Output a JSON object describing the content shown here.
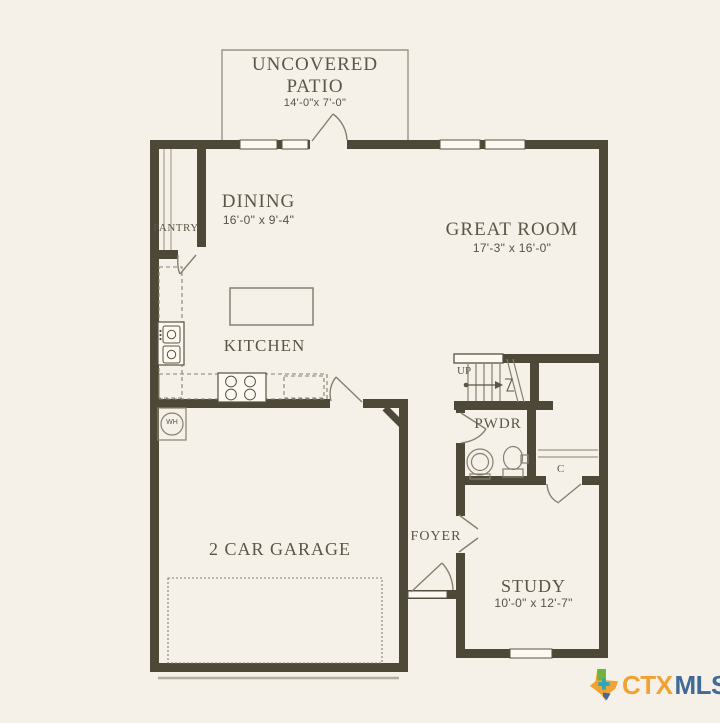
{
  "rooms": {
    "patio": {
      "name": "UNCOVERED PATIO",
      "dims": "14'-0\"x 7'-0\""
    },
    "dining": {
      "name": "DINING",
      "dims": "16'-0\" x 9'-4\""
    },
    "great_room": {
      "name": "GREAT ROOM",
      "dims": "17'-3\" x 16'-0\""
    },
    "pantry": {
      "name": "PANTRY"
    },
    "kitchen": {
      "name": "KITCHEN"
    },
    "powder": {
      "name": "PWDR"
    },
    "foyer": {
      "name": "FOYER"
    },
    "garage": {
      "name": "2 CAR GARAGE"
    },
    "study": {
      "name": "STUDY",
      "dims": "10'-0\" x 12'-7\""
    }
  },
  "annotations": {
    "stairs_direction": "UP",
    "closet": "C",
    "water_heater": "WH"
  },
  "logo": {
    "prefix": "CTX",
    "suffix": "MLS",
    "icon": "texas-icon"
  },
  "colors": {
    "background": "#f5f1e8",
    "wall": "#4e4839",
    "line": "#85806f",
    "label_text": "#5c5646",
    "logo_orange": "#f0a233",
    "logo_blue": "#3f6b96",
    "logo_green": "#6cb33f",
    "logo_teal": "#2aa7b8"
  }
}
